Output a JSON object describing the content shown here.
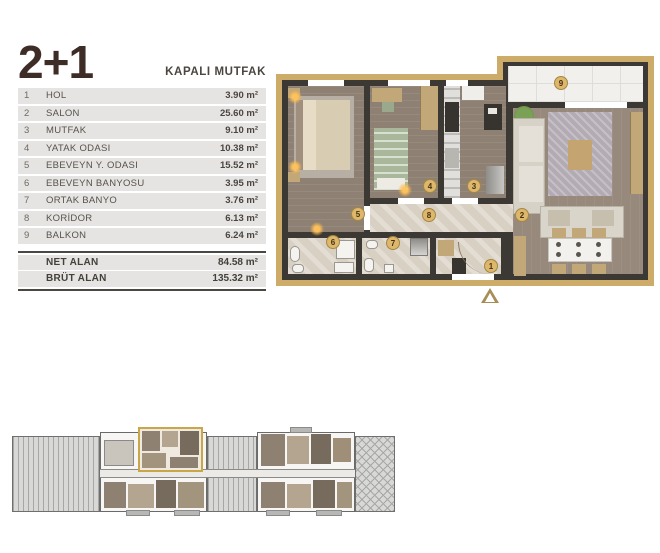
{
  "header": {
    "title": "2+1",
    "subtitle": "KAPALI MUTFAK"
  },
  "room_table": {
    "rows": [
      {
        "no": "1",
        "name": "HOL",
        "area": "3.90 m²"
      },
      {
        "no": "2",
        "name": "SALON",
        "area": "25.60 m²"
      },
      {
        "no": "3",
        "name": "MUTFAK",
        "area": "9.10 m²"
      },
      {
        "no": "4",
        "name": "YATAK ODASI",
        "area": "10.38 m²"
      },
      {
        "no": "5",
        "name": "EBEVEYN Y. ODASI",
        "area": "15.52 m²"
      },
      {
        "no": "6",
        "name": "EBEVEYN BANYOSU",
        "area": "3.95 m²"
      },
      {
        "no": "7",
        "name": "ORTAK BANYO",
        "area": "3.76 m²"
      },
      {
        "no": "8",
        "name": "KORİDOR",
        "area": "6.13 m²"
      },
      {
        "no": "9",
        "name": "BALKON",
        "area": "6.24 m²"
      }
    ]
  },
  "summary": {
    "rows": [
      {
        "label": "NET ALAN",
        "value": "84.58 m²"
      },
      {
        "label": "BRÜT ALAN",
        "value": "135.32 m²"
      }
    ]
  },
  "floorplan": {
    "badges": [
      "1",
      "2",
      "3",
      "4",
      "5",
      "6",
      "7",
      "8",
      "9"
    ],
    "icons": {
      "entrance_arrow": "triangle-up-arrow"
    }
  },
  "colors": {
    "accent_gold": "#cdab69",
    "badge_gold": "#dcb76c",
    "wall": "#3c3935",
    "wood_floor": "#8e8173",
    "marble_floor": "#d9d0c4",
    "table_row_gray": "#e5e4e2",
    "title_brown": "#3e2c26"
  }
}
